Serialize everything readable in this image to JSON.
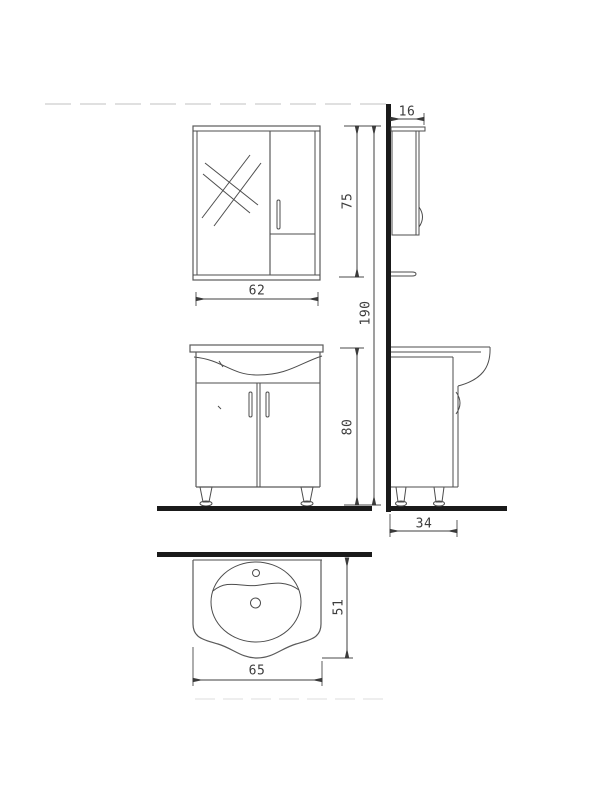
{
  "drawing": {
    "type": "technical-drawing",
    "subject": "bathroom vanity set: mirror cabinet, washbasin cabinet, basin top view",
    "background_color": "#ffffff",
    "line_color": "#4d4d4d",
    "heavy_line_color": "#1a1a1a",
    "text_color": "#3d3d3d"
  },
  "views": {
    "mirror_cabinet_front": "mirror cabinet front view",
    "mirror_cabinet_side": "mirror cabinet side view",
    "vanity_front": "washbasin cabinet front view",
    "vanity_side": "washbasin cabinet side view",
    "basin_top": "washbasin top view"
  },
  "dimensions": {
    "mirror_width": "62",
    "mirror_height": "75",
    "mirror_depth": "16",
    "total_height": "190",
    "vanity_height": "80",
    "vanity_depth": "34",
    "basin_width": "65",
    "basin_depth": "51"
  }
}
